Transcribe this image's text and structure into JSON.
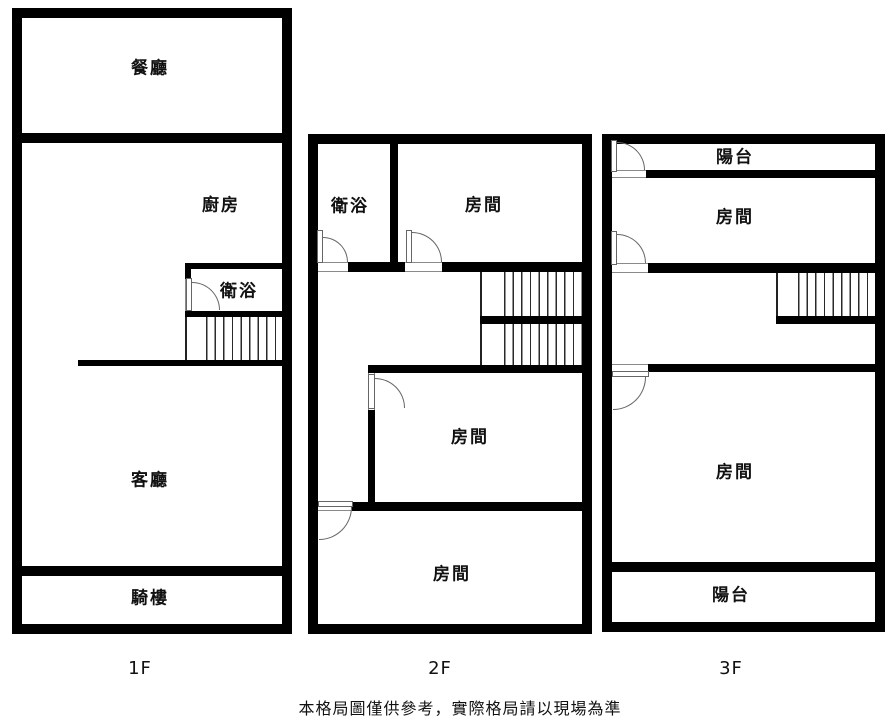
{
  "floors": [
    {
      "floor_label": "1F",
      "rooms": {
        "dining": "餐廳",
        "kitchen": "廚房",
        "bathroom": "衛浴",
        "living": "客廳",
        "arcade": "騎樓"
      }
    },
    {
      "floor_label": "2F",
      "rooms": {
        "bathroom": "衛浴",
        "room_top": "房間",
        "room_middle": "房間",
        "room_bottom": "房間"
      }
    },
    {
      "floor_label": "3F",
      "rooms": {
        "balcony_top": "陽台",
        "room_top": "房間",
        "room_main": "房間",
        "balcony_bottom": "陽台"
      }
    }
  ],
  "footer": {
    "disclaimer": "本格局圖僅供參考，實際格局請以現場為準"
  },
  "colors": {
    "wall": "#000000",
    "background": "#ffffff",
    "door_line": "#666666",
    "stair_line": "#2a2a2a",
    "text": "#111111"
  }
}
